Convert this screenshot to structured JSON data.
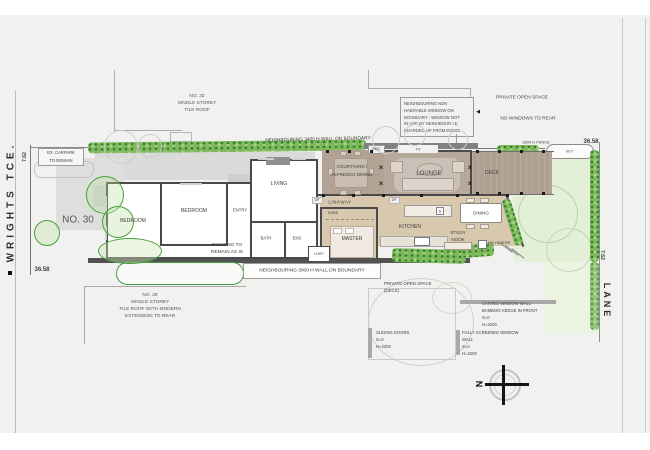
{
  "colors": {
    "canvas": "#f1f1ef",
    "existing_wall": "#4a4a4a",
    "new_floor": "#d8c9ae",
    "pavilion_floor": "#b6a89b",
    "deck_floor": "#afa092",
    "vegetation": "#43a043"
  },
  "streets": {
    "left": "WRIGHTS TCE.",
    "lane": "LANE"
  },
  "dims": {
    "front_width": "7.62",
    "front_depth": "36.58",
    "rear_depth": "36.58",
    "rear_width": "7.62"
  },
  "site": {
    "number": "NO. 30",
    "rooms": {
      "bedroom1": "BEDROOM",
      "bedroom2": "BEDROOM",
      "entry": "ENTRY",
      "living": "LIVING",
      "bath": "BATH",
      "ens": "ENS",
      "ldry": "LDRY",
      "linkway": "LINKWAY",
      "robe": "ROBE",
      "master": "MASTER",
      "kitchen": "KITCHEN",
      "dining": "DINING",
      "study": [
        "STUDY",
        "NOOK"
      ],
      "lounge": "LOUNGE",
      "deck": "DECK",
      "courtyard": [
        "COURTYARD /",
        "ALFRESCO DINING"
      ]
    },
    "fixtures": {
      "tv": "TV",
      "bbq": "BBQ",
      "sink": "S",
      "water_tank": "W.T.",
      "hw_heater": "HW HEATER",
      "dp": "DP"
    },
    "notes": {
      "carpark": [
        "EX. CARPARK",
        "TO REMAIN"
      ],
      "existing": [
        "EXISTING TO",
        "REMAIN AS IS"
      ],
      "pos_deck": [
        "PRIVATE OPEN SPACE",
        "(DECK)"
      ],
      "sliding": [
        "SLIDING DOORS",
        "S=0",
        "H=2200"
      ],
      "canted": [
        "CANTED WINDOW WALL",
        "BAMBOO HEDGE IN FRONT",
        "S=0",
        "H=2200"
      ],
      "screened": [
        "FULLY SCREENED WINDOW",
        "WALL",
        "S=0",
        "H=2200"
      ],
      "fence": "1800 H FENCE"
    }
  },
  "neighbours": {
    "no32": [
      "NO. 32",
      "SINGLE STOREY",
      "TILE ROOF"
    ],
    "no28": [
      "NO. 28",
      "SINGLE STOREY",
      "TILE ROOF WITH MODERN",
      "EXTENSION TO REAR"
    ],
    "private_open_space": "PRIVATE OPEN SPACE",
    "no_windows": "NO WINDOWS TO REAR",
    "window_note": [
      "NEIGHBOURING NON",
      "HABITABLE WINDOW ON",
      "BOUNDARY - WINDOW NOT",
      "IN USE BY NEIGHBOUR I.E.",
      "BOARDED UP FROM INSIDE"
    ],
    "wall_north": "NEIGHBOURING 3400 H WALL ON BOUNDARY",
    "wall_south": "NEIGHBOURING 3000 H WALL ON BOUNDARY"
  },
  "compass": {
    "north": "N"
  }
}
